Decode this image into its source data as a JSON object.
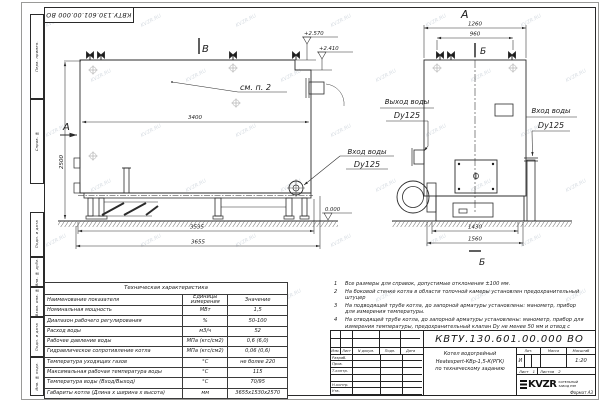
{
  "page": {
    "watermark_text": "KVZR.RU",
    "line_color": "#2b2b2b"
  },
  "stamp_top": {
    "doc_number_inverted": "КВТУ.130.601.00.000  ВО"
  },
  "margin_fields": [
    {
      "label": "Перв. примен."
    },
    {
      "label": "Справ. №"
    },
    {
      "label": "Подп. и дата"
    },
    {
      "label": "Инв. № дубл."
    },
    {
      "label": "Взам. инв. №"
    },
    {
      "label": "Подп. и дата"
    },
    {
      "label": "Инв. № подл."
    }
  ],
  "views": {
    "side": {
      "section_b": "В",
      "section_a": "А",
      "see_note": "см. п. 2",
      "dim_width_top": "3400",
      "dim_height": "2500",
      "dim_base": "3535",
      "dim_overall": "3655",
      "elev_top": "+2.570",
      "elev_step": "+2.410",
      "elev_zero": "0.000",
      "inlet_callout": {
        "line1": "Вход воды",
        "line2": "Dy125"
      }
    },
    "front": {
      "view_label": "А",
      "section_label_top": "Б",
      "section_label_bottom": "Б",
      "dim_width_top": "1260",
      "dim_valves": "960",
      "dim_base": "1430",
      "dim_overall": "1560",
      "outlet_callout": {
        "line1": "Выход воды",
        "line2": "Dy125"
      },
      "inlet_callout": {
        "line1": "Вход воды",
        "line2": "Dy125"
      }
    }
  },
  "spec_table": {
    "title": "Техническая характеристика",
    "headers": [
      "Наименование показателя",
      "Единицы измерения",
      "Значение"
    ],
    "rows": [
      [
        "Номинальная мощность",
        "МВт",
        "1,5"
      ],
      [
        "Диапазон рабочего регулирования",
        "%",
        "50-100"
      ],
      [
        "Расход воды",
        "м3/ч",
        "52"
      ],
      [
        "Рабочее давление воды",
        "МПа (кгс/см2)",
        "0,6 (6,0)"
      ],
      [
        "Гидравлическое сопротивление котла",
        "МПа (кгс/см2)",
        "0,06 (0,6)"
      ],
      [
        "Температура уходящих газов",
        "°С",
        "не более 220"
      ],
      [
        "Максимальная рабочая температура воды",
        "°С",
        "115"
      ],
      [
        "Температура воды (Вход/Выход)",
        "°С",
        "70/95"
      ],
      [
        "Габариты котла (Длина х ширина х высота)",
        "мм",
        "3655х1530х2570"
      ]
    ]
  },
  "notes": [
    {
      "num": "1",
      "text": "Все размеры для справок, допустимые отклонения ±100 мм."
    },
    {
      "num": "2",
      "text": "На боковой стенке котла в области топочной камеры установлен предохранительный штуцер"
    },
    {
      "num": "3",
      "text": "На подводящей трубе котла, до запорной арматуры установлены: манометр, прибор для измерения температуры."
    },
    {
      "num": "4",
      "text": "На отводящей трубе котла, до запорной арматуры установлены: манометр, прибор для измерения температуры, предохранительный клапан Dу не менее 50 мм и отвод с обратным клапаном Dу не менее 50 мм."
    }
  ],
  "title_block": {
    "doc_number": "КВТУ.130.601.00.000  ВО",
    "name_line1": "Котел водогрейный",
    "name_line2": "Heatexpert-КВр-1,5-К(РГК)",
    "name_line3": "по техническому заданию",
    "header_cells": [
      "Изм.",
      "Лист",
      "N докум.",
      "Подп.",
      "Дата"
    ],
    "row_labels": [
      "Разраб.",
      "Пров.",
      "Т.контр.",
      "",
      "Н.контр.",
      "Утв."
    ],
    "lit_header": "Лит.",
    "mass_header": "Масса",
    "scale_header": "Масштаб",
    "lit_value": "И",
    "scale_value": "1:20",
    "sheet_label": "Лист",
    "sheet_value": "1",
    "sheets_label": "Листов",
    "sheets_value": "2",
    "logo_text": "KVZR",
    "logo_sub1": "КОТЕЛЬНЫЙ",
    "logo_sub2": "ЗАВОД РЭП",
    "format_label": "Формат  А3"
  }
}
